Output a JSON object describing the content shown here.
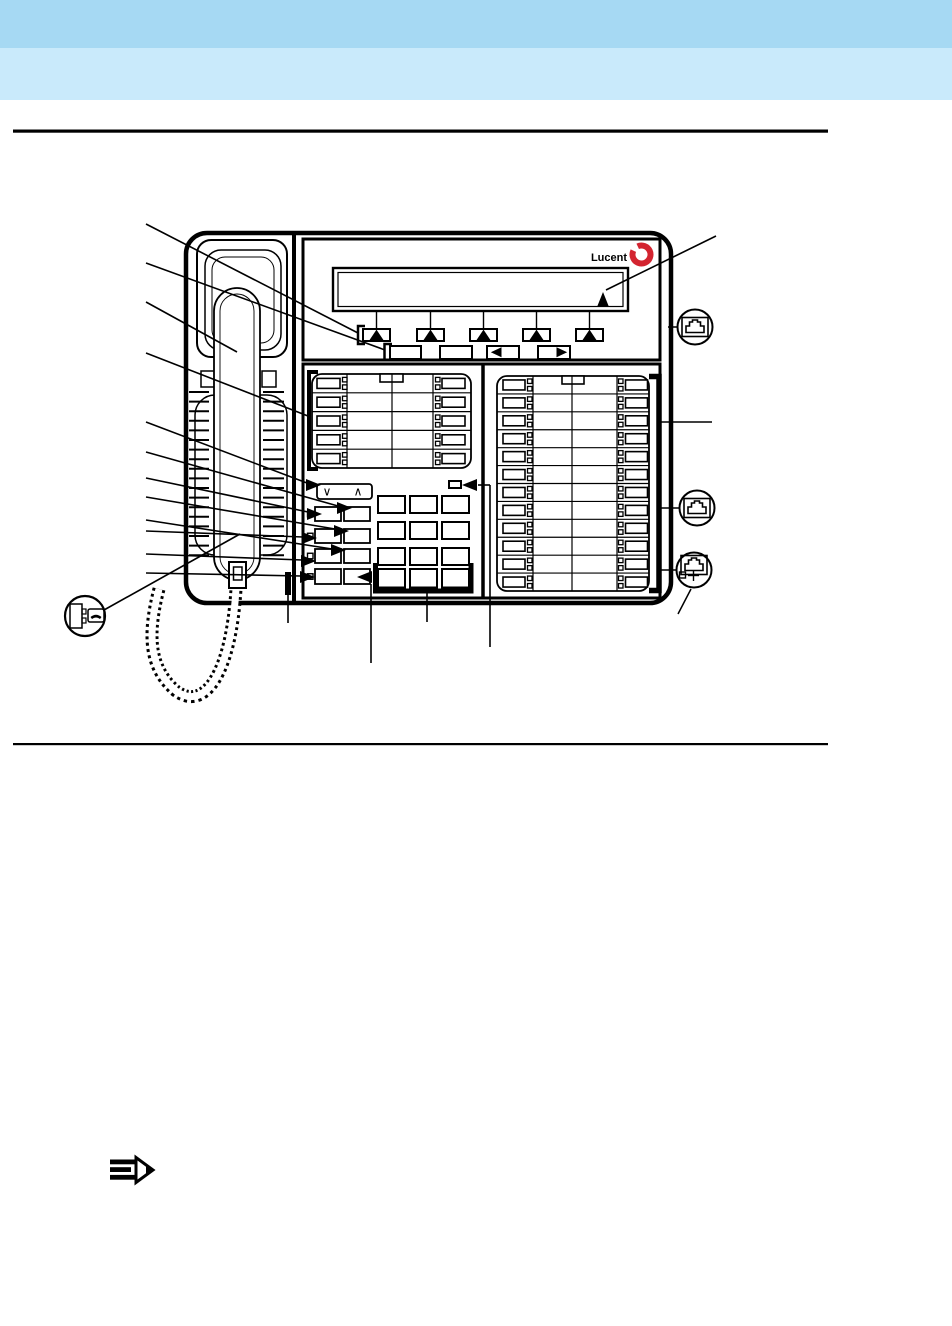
{
  "page": {
    "band_top_color": "#a6d9f3",
    "band_bottom_color": "#c9eafb",
    "rule_color": "#000000",
    "background_color": "#ffffff"
  },
  "phone": {
    "brand_label": "Lucent",
    "brand_ring_color": "#d32430",
    "outline_color": "#000000",
    "display_softkeys": 5,
    "nav_buttons": 4,
    "left_field_rows": 5,
    "right_field_rows": 12,
    "dialpad_rows": 4,
    "dialpad_cols": 3,
    "fixed_button_rows": 4,
    "fixed_button_cols": 2,
    "volume_down_symbol": "∨",
    "volume_up_symbol": "∧"
  }
}
